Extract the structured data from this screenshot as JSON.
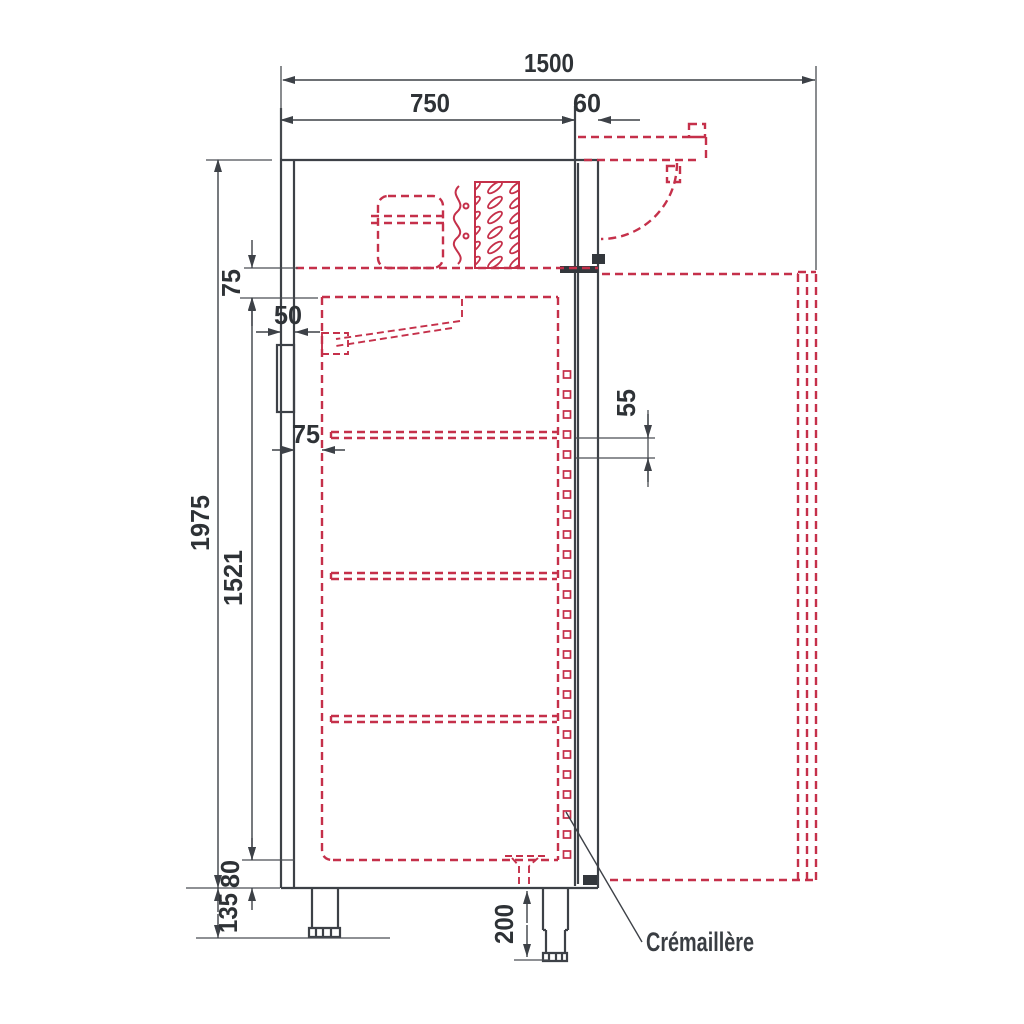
{
  "diagram": {
    "type": "technical-drawing-side-section",
    "subject": "refrigerated-cabinet",
    "colors": {
      "ink": "#3d4147",
      "accent_red": "#c5304a",
      "background": "#ffffff"
    },
    "labels": {
      "rack": "Crémaillère"
    },
    "dims": {
      "total_depth_open": "1500",
      "body_depth": "750",
      "door_thickness": "60",
      "top_insulation": "75",
      "wall_spacer": "50",
      "back_insulation": "75",
      "overall_height": "1975",
      "interior_height": "1521",
      "rack_pitch": "55",
      "bottom_insulation": "80",
      "leg_min": "135",
      "leg_max": "200"
    }
  }
}
